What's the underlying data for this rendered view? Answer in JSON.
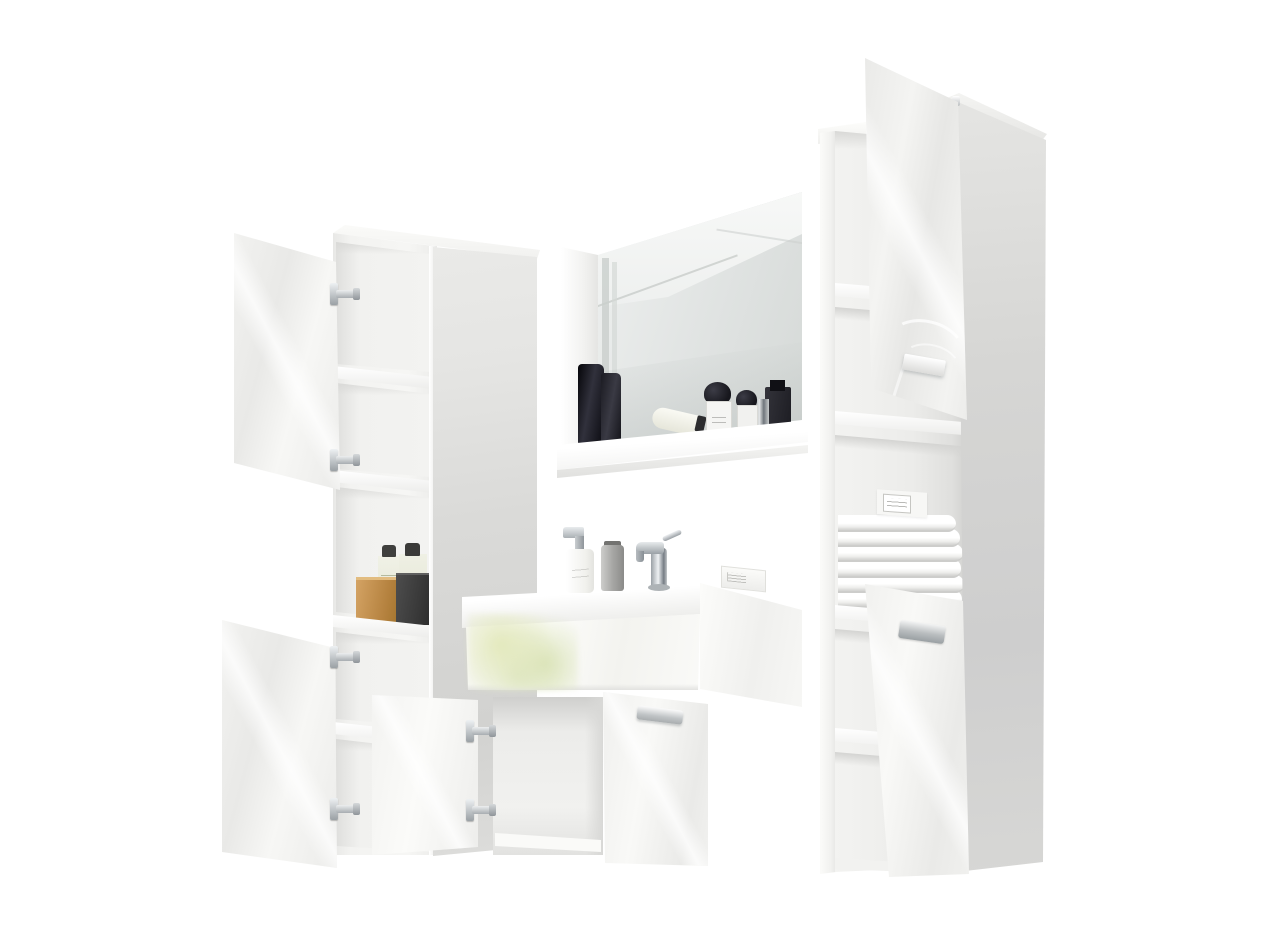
{
  "scene": {
    "type": "product-photo",
    "subject": "White high-gloss bathroom furniture set on white background",
    "furniture": [
      {
        "id": "left-tall-cabinet",
        "label": "Tall storage cabinet with two open gloss doors and open shelves",
        "items": {
          "bottle1": "green-label cosmetic bottle",
          "bottle2": "green-label cosmetic bottle",
          "woodBox": "wooden box",
          "blackBox": "black storage box"
        }
      },
      {
        "id": "wall-mirror",
        "label": "Wall mirror with display shelf",
        "items": {
          "darkBottle1": "tall black bottle",
          "darkBottle2": "black bottle",
          "tube": "white cosmetic tube",
          "perfume1": "perfume bottle with black cap",
          "perfume2": "perfume bottle with black cap",
          "chromeJar": "chrome canister",
          "darkFlacon": "dark flacon"
        }
      },
      {
        "id": "sink-vanity",
        "label": "Washbasin vanity with open left door and closed right door",
        "items": {
          "soap": "white soap dispenser",
          "bottle": "silver cosmetic bottle",
          "faucet": "chrome single-lever faucet",
          "box": "small white box"
        }
      },
      {
        "id": "right-tall-cabinet",
        "label": "Tall open-shelf cabinet with two open gloss doors",
        "items": {
          "towels": "stack of six folded white towels",
          "box": "white cosmetic box"
        }
      }
    ]
  },
  "colors": {
    "bg": "#ffffff",
    "gloss-a": "#f4f4f2",
    "gloss-b": "#e9e9e7",
    "side-a": "#e5e5e3",
    "side-b": "#d2d2d0",
    "interior": "#f1f1ef",
    "ishadow": "#d8d8d6",
    "chrome-l": "#eef1f3",
    "chrome-d": "#8f959a",
    "towel": "#ffffff",
    "towel-sh": "#d5d5d3",
    "glass-a": "#eef0ef",
    "glass-b": "#d5d9d7",
    "wood-a": "#d4a364",
    "wood-b": "#a5762f",
    "black-box": "#3a3a3a",
    "bottle-dark": "#14141a",
    "foliage": "#e4ead0",
    "label-line": "#a9a9a5"
  }
}
